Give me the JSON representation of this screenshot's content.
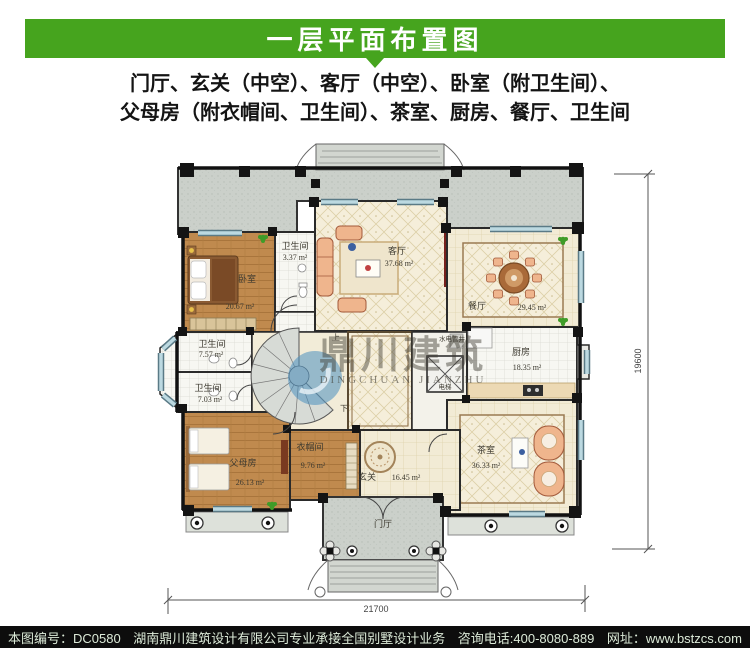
{
  "header": {
    "title": "一层平面布置图"
  },
  "description": {
    "line1": "门厅、玄关（中空）、客厅（中空）、卧室（附卫生间）、",
    "line2": "父母房（附衣帽间、卫生间）、茶室、厨房、餐厅、卫生间"
  },
  "plan": {
    "rooms": [
      {
        "name": "卧室",
        "area": "20.67 m²"
      },
      {
        "name": "卫生间",
        "area": "3.37 m²"
      },
      {
        "name": "客厅",
        "area": "37.68 m²"
      },
      {
        "name": "餐厅",
        "area": "29.45 m²"
      },
      {
        "name": "卫生间",
        "area": "7.57 m²"
      },
      {
        "name": "卫生间",
        "area": "7.03 m²"
      },
      {
        "name": "父母房",
        "area": "26.13 m²"
      },
      {
        "name": "衣帽间",
        "area": "9.76 m²"
      },
      {
        "name": "玄关",
        "area": "16.45 m²"
      },
      {
        "name": "厨房",
        "area": "18.35 m²"
      },
      {
        "name": "茶室",
        "area": "36.33 m²"
      }
    ],
    "labels": {
      "porch": "门厅",
      "elevator": "电梯",
      "shaft": "水电管井",
      "stairs_up": "上",
      "stairs_down": "下"
    },
    "dimensions": {
      "width": "21700",
      "height": "19600"
    },
    "watermark": {
      "cn": "鼎川建筑",
      "en": "DINGCHUAN JIANZHU"
    }
  },
  "footer": {
    "plan_no": "本图编号：DC0580",
    "company": "湖南鼎川建筑设计有限公司专业承接全国别墅设计业务",
    "phone": "咨询电话:400-8080-889",
    "website": "网址：www.bstzcs.com"
  },
  "colors": {
    "accent_green": "#46a41e",
    "footer_bg": "#0d0d0d",
    "footer_text": "#dcead8",
    "window_blue": "#bcd9e1",
    "wood": "#c08a4e",
    "tile_cream": "#f2ebd5",
    "terrace_gray": "#cbd0ca",
    "watermark_blue": "#4a8fc0"
  }
}
